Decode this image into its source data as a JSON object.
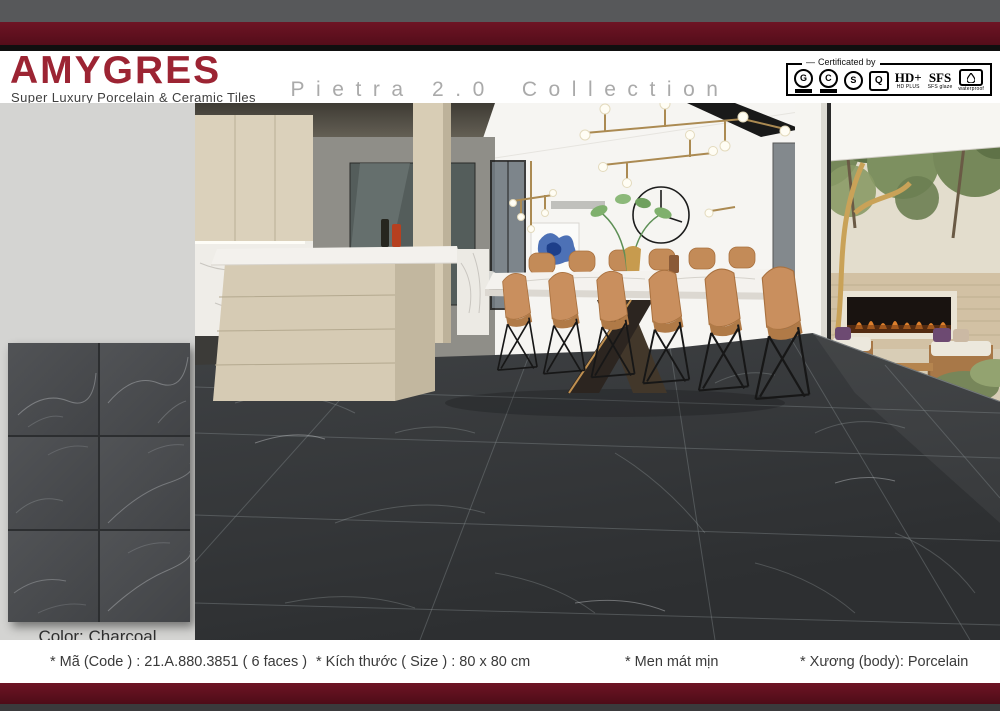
{
  "header": {
    "brand": "AMYGRES",
    "tagline": "Super Luxury Porcelain & Ceramic Tiles",
    "collection_title_main": "Pietra 2.0",
    "collection_title_sub": "Collection",
    "certified_label": "Certificated by",
    "badges": {
      "iso1_letter": "G",
      "iso2_letter": "C",
      "s_letter": "S",
      "q_letter": "Q",
      "hd_main": "HD+",
      "hd_sub": "HD PLUS",
      "sfs_main": "SFS",
      "sfs_sub": "SFS glaze",
      "waterproof_label": "waterproof"
    }
  },
  "swatch": {
    "color_label": "Color: Charcoal"
  },
  "specs": [
    "* Mã (Code ) : 21.A.880.3851 ( 6 faces )",
    "* Kích thước ( Size ) : 80 x 80 cm",
    "* Men mát mịn",
    "* Xương (body): Porcelain"
  ],
  "colors": {
    "brand_red": "#9c2433",
    "bar_maroon": "#5f0f1e",
    "tile_charcoal": "#46484b"
  }
}
